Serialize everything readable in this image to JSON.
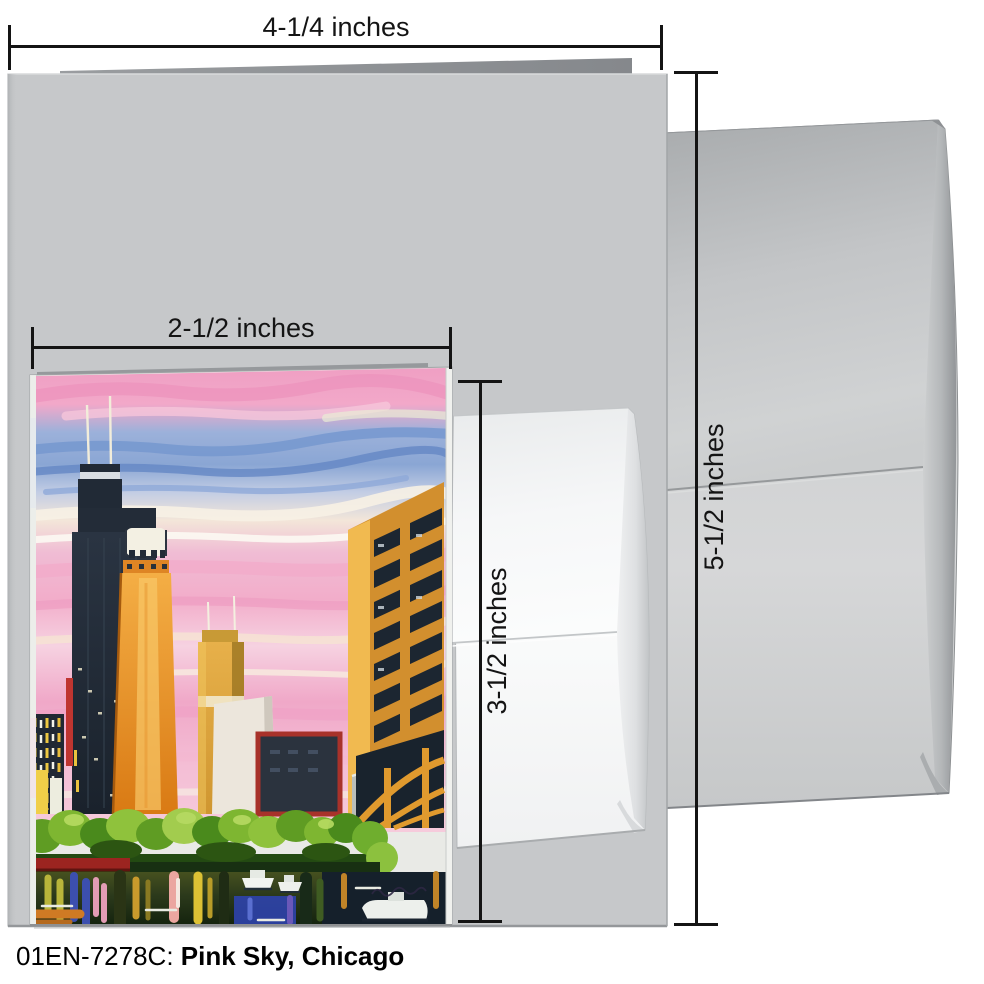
{
  "product": {
    "code": "01EN-7278C:",
    "title": "Pink Sky, Chicago"
  },
  "measurements": {
    "card_width": "4-1/4 inches",
    "card_height": "5-1/2 inches",
    "insert_width": "2-1/2 inches",
    "insert_height": "3-1/2 inches"
  },
  "colors": {
    "background": "#ffffff",
    "measure_line": "#141414",
    "large_card_gray": "#c6c8ca",
    "large_card_fold": "#8e9194",
    "envelope_gray_light": "#d6d7d8",
    "envelope_gray_dark": "#a8abad",
    "small_envelope_white": "#fafbfb",
    "painting_sky_pink": "#f2adca",
    "painting_sky_blue": "#7598cf",
    "painting_sky_cream": "#f7f1e4",
    "painting_tower_dark": "#212a36",
    "painting_building_orange": "#e8952f",
    "painting_marina_gold": "#d28f2e",
    "painting_red_accent": "#a8322a",
    "painting_trees_green": "#7eb631",
    "painting_water_blue": "#2e42a8"
  }
}
